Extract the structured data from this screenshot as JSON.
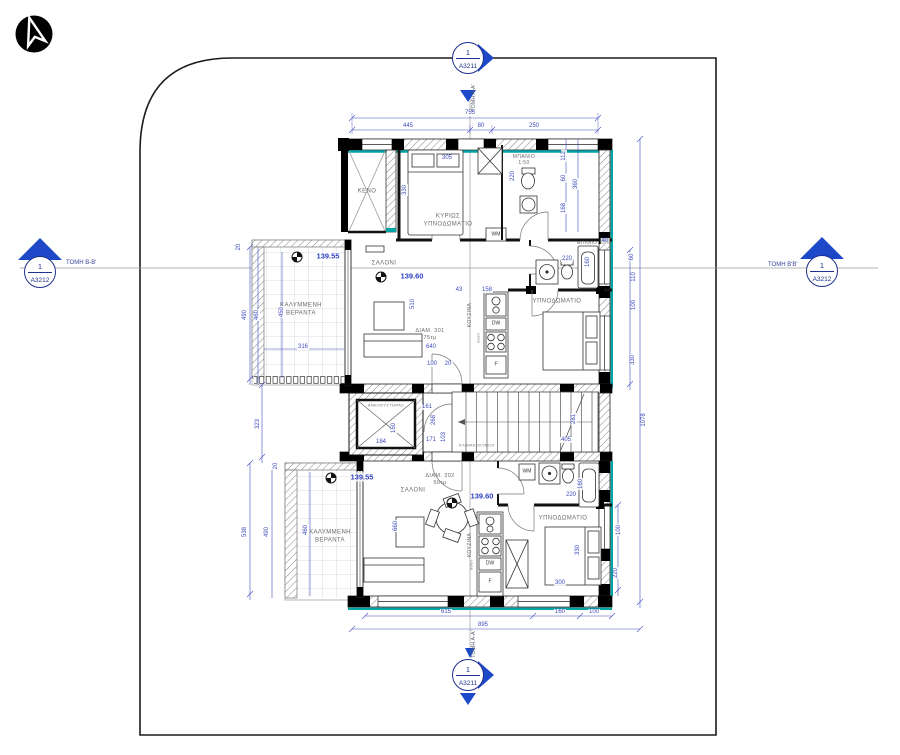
{
  "drawing_colors": {
    "dimension_blue": "#3f4dbe",
    "marker_blue": "#1d49c8",
    "insulation_teal": "#00a3a3",
    "wall_black": "#000000"
  },
  "section_markers": {
    "top": {
      "num": "1",
      "sheet": "A3211",
      "label": "ΤΟΜΗ Α-Α'"
    },
    "bottom": {
      "num": "1",
      "sheet": "A3211",
      "label": "ΤΟΜΗ Α-Α'"
    },
    "left": {
      "num": "1",
      "sheet": "A3212",
      "label": "ΤΟΜΗ Β-Β'"
    },
    "right": {
      "num": "1",
      "sheet": "A3212",
      "label": "ΤΟΜΗ Β'Β'"
    }
  },
  "plan": {
    "room_labels": [
      {
        "id": "void",
        "text": "ΚΕΝΟ",
        "x": 367,
        "y": 192,
        "fs": 6
      },
      {
        "id": "master-bedroom",
        "text": "ΚΥΡΙΩΣ\nΥΠΝΟΔΩΜΑΤΙΟ",
        "x": 448,
        "y": 221,
        "fs": 6
      },
      {
        "id": "bathroom-top",
        "text": "ΜΠΑΝΙΟ\n1:50",
        "x": 524,
        "y": 160,
        "fs": 5
      },
      {
        "id": "living-upper",
        "text": "ΣΑΛΟΝΙ",
        "x": 384,
        "y": 264,
        "fs": 6
      },
      {
        "id": "veranda-upper",
        "text": "ΚΑΛΥΜΜΕΝΗ\nΒΕΡΑΝΤΑ",
        "x": 301,
        "y": 310,
        "fs": 6
      },
      {
        "id": "apartment-301",
        "text": "ΔΙΑΜ. 301\n75τμ",
        "x": 430,
        "y": 335,
        "fs": 5.5
      },
      {
        "id": "kitchen-upper",
        "text": "ΚΟΥΖΙΝΑ",
        "x": 470,
        "y": 315,
        "fs": 5,
        "rot": 1
      },
      {
        "id": "oven-upper",
        "text": "oven",
        "x": 478,
        "y": 338,
        "fs": 4,
        "rot": 1
      },
      {
        "id": "bedroom-upper",
        "text": "ΥΠΝΟΔΩΜΑΤΙΟ",
        "x": 557,
        "y": 302,
        "fs": 6
      },
      {
        "id": "bathroom-mid",
        "text": "ΜΠΑΝΙΟ",
        "x": 587,
        "y": 243,
        "fs": 4.5
      },
      {
        "id": "elevator",
        "text": "ΑΝΕΛΚΥΣΤΗΡΑΣ",
        "x": 386,
        "y": 405,
        "fs": 4
      },
      {
        "id": "staircase",
        "text": "ΚΛΙΜΑΚΟΣΤΑΣΙΟ",
        "x": 477,
        "y": 446,
        "fs": 3.8
      },
      {
        "id": "living-lower",
        "text": "ΣΑΛΟΝΙ",
        "x": 413,
        "y": 491,
        "fs": 6
      },
      {
        "id": "apartment-302",
        "text": "ΔΙΑΜ. 302\n50τμ",
        "x": 440,
        "y": 480,
        "fs": 5.5
      },
      {
        "id": "veranda-lower",
        "text": "ΚΑΛΥΜΜΕΝΗ\nΒΕΡΑΝΤΑ",
        "x": 330,
        "y": 537,
        "fs": 6
      },
      {
        "id": "kitchen-lower",
        "text": "ΚΟΥΖΙΝΑ",
        "x": 470,
        "y": 545,
        "fs": 5,
        "rot": 1
      },
      {
        "id": "oven-lower",
        "text": "oven",
        "x": 471,
        "y": 565,
        "fs": 4,
        "rot": 1
      },
      {
        "id": "bedroom-lower",
        "text": "ΥΠΝΟΔΩΜΑΤΙΟ",
        "x": 563,
        "y": 519,
        "fs": 6
      }
    ],
    "fixture_labels": [
      {
        "text": "WM",
        "x": 496,
        "y": 235
      },
      {
        "text": "DW",
        "x": 496,
        "y": 324
      },
      {
        "text": "F",
        "x": 496,
        "y": 365
      },
      {
        "text": "WM",
        "x": 527,
        "y": 472
      },
      {
        "text": "DW",
        "x": 490,
        "y": 564
      },
      {
        "text": "F",
        "x": 490,
        "y": 582
      }
    ],
    "level_markers": [
      {
        "value": "139.55",
        "x": 316,
        "y": 256,
        "sx": 297,
        "sy": 257
      },
      {
        "value": "139.60",
        "x": 400,
        "y": 276,
        "sx": 381,
        "sy": 277
      },
      {
        "value": "139.55",
        "x": 350,
        "y": 477,
        "sx": 331,
        "sy": 478
      },
      {
        "value": "139.60",
        "x": 470,
        "y": 496,
        "sx": 452,
        "sy": 503
      }
    ],
    "dim_labels": [
      {
        "v": "755",
        "x": 470,
        "y": 113
      },
      {
        "v": "445",
        "x": 408,
        "y": 126
      },
      {
        "v": "80",
        "x": 481,
        "y": 126
      },
      {
        "v": "250",
        "x": 534,
        "y": 126
      },
      {
        "v": "615",
        "x": 446,
        "y": 612
      },
      {
        "v": "160",
        "x": 560,
        "y": 612
      },
      {
        "v": "100",
        "x": 594,
        "y": 612
      },
      {
        "v": "895",
        "x": 483,
        "y": 625
      },
      {
        "v": "20",
        "x": 239,
        "y": 247,
        "rot": 1
      },
      {
        "v": "490",
        "x": 245,
        "y": 315,
        "rot": 1
      },
      {
        "v": "460",
        "x": 257,
        "y": 315,
        "rot": 1
      },
      {
        "v": "450",
        "x": 282,
        "y": 312,
        "rot": 1
      },
      {
        "v": "316",
        "x": 303,
        "y": 347
      },
      {
        "v": "323",
        "x": 258,
        "y": 424,
        "rot": 1
      },
      {
        "v": "20",
        "x": 276,
        "y": 466,
        "rot": 1
      },
      {
        "v": "538",
        "x": 245,
        "y": 532,
        "rot": 1
      },
      {
        "v": "490",
        "x": 267,
        "y": 532,
        "rot": 1
      },
      {
        "v": "460",
        "x": 306,
        "y": 530,
        "rot": 1
      },
      {
        "v": "112",
        "x": 564,
        "y": 156,
        "rot": 1
      },
      {
        "v": "60",
        "x": 564,
        "y": 178,
        "rot": 1
      },
      {
        "v": "168",
        "x": 564,
        "y": 208,
        "rot": 1
      },
      {
        "v": "360",
        "x": 576,
        "y": 184,
        "rot": 1
      },
      {
        "v": "220",
        "x": 513,
        "y": 176,
        "rot": 1
      },
      {
        "v": "330",
        "x": 405,
        "y": 190,
        "rot": 1
      },
      {
        "v": "305",
        "x": 447,
        "y": 158
      },
      {
        "v": "43",
        "x": 459,
        "y": 290
      },
      {
        "v": "158",
        "x": 487,
        "y": 290
      },
      {
        "v": "100",
        "x": 432,
        "y": 364
      },
      {
        "v": "20",
        "x": 448,
        "y": 364
      },
      {
        "v": "640",
        "x": 431,
        "y": 347
      },
      {
        "v": "510",
        "x": 413,
        "y": 304,
        "rot": 1
      },
      {
        "v": "220",
        "x": 567,
        "y": 259
      },
      {
        "v": "160",
        "x": 588,
        "y": 262,
        "rot": 1
      },
      {
        "v": "40",
        "x": 605,
        "y": 241
      },
      {
        "v": "60",
        "x": 632,
        "y": 257,
        "rot": 1
      },
      {
        "v": "110",
        "x": 634,
        "y": 277,
        "rot": 1
      },
      {
        "v": "100",
        "x": 634,
        "y": 305,
        "rot": 1
      },
      {
        "v": "330",
        "x": 633,
        "y": 360,
        "rot": 1
      },
      {
        "v": "161",
        "x": 427,
        "y": 407
      },
      {
        "v": "268",
        "x": 434,
        "y": 420,
        "rot": 1
      },
      {
        "v": "150",
        "x": 394,
        "y": 428,
        "rot": 1
      },
      {
        "v": "184",
        "x": 381,
        "y": 442
      },
      {
        "v": "171",
        "x": 431,
        "y": 440
      },
      {
        "v": "103",
        "x": 444,
        "y": 437,
        "rot": 1
      },
      {
        "v": "405",
        "x": 566,
        "y": 440
      },
      {
        "v": "281",
        "x": 574,
        "y": 419,
        "rot": 1
      },
      {
        "v": "660",
        "x": 396,
        "y": 526,
        "rot": 1
      },
      {
        "v": "220",
        "x": 571,
        "y": 495
      },
      {
        "v": "160",
        "x": 581,
        "y": 484,
        "rot": 1
      },
      {
        "v": "330",
        "x": 578,
        "y": 550,
        "rot": 1
      },
      {
        "v": "300",
        "x": 560,
        "y": 583
      },
      {
        "v": "100",
        "x": 619,
        "y": 530,
        "rot": 1
      },
      {
        "v": "220",
        "x": 616,
        "y": 573,
        "rot": 1
      },
      {
        "v": "1078",
        "x": 644,
        "y": 420,
        "rot": 1
      }
    ]
  }
}
